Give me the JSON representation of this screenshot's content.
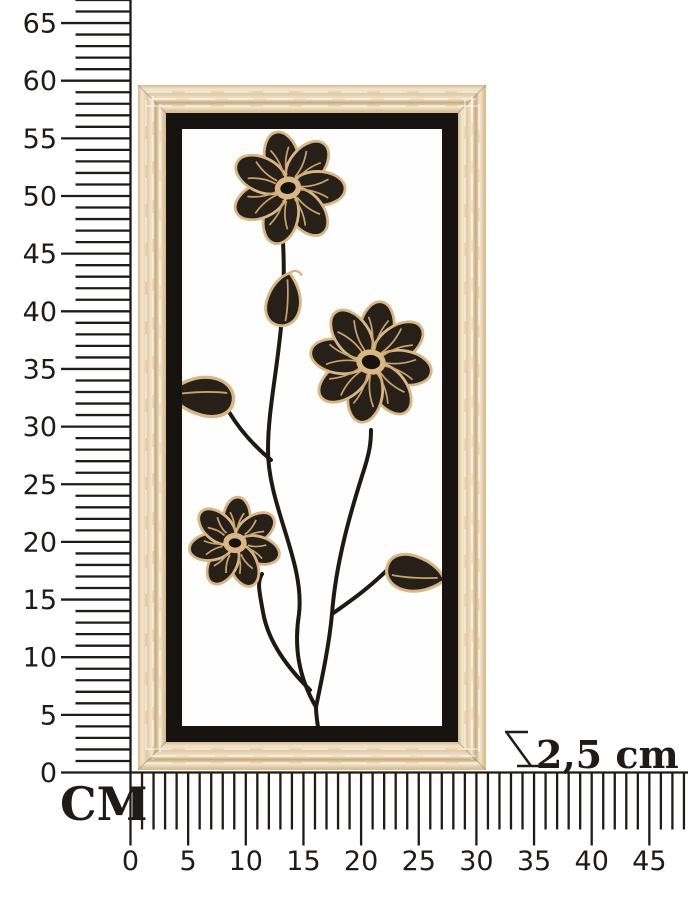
{
  "ruler": {
    "unit_label": "CM",
    "vertical_tick_labels": [
      65,
      60,
      55,
      50,
      45,
      40,
      35,
      30,
      25,
      20,
      15,
      10,
      5,
      0
    ],
    "horizontal_tick_labels": [
      0,
      5,
      10,
      15,
      20,
      25,
      30,
      35,
      40,
      45
    ]
  },
  "annotation": {
    "depth_value": "2,5 cm"
  },
  "colors": {
    "ink": "#1e1b18",
    "wood_base": "#e3c9a1",
    "wood_light": "#f2e7d1",
    "wood_dark": "#d6b88a",
    "wood_deep": "#c9a97a",
    "inner_frame": "#171310",
    "canvas": "#fefefe",
    "flower_fill": "#262019",
    "flower_outline": "#d8b685",
    "flower_vein": "#c9a36f",
    "stem": "#1d1a16",
    "background": "#ffffff"
  }
}
